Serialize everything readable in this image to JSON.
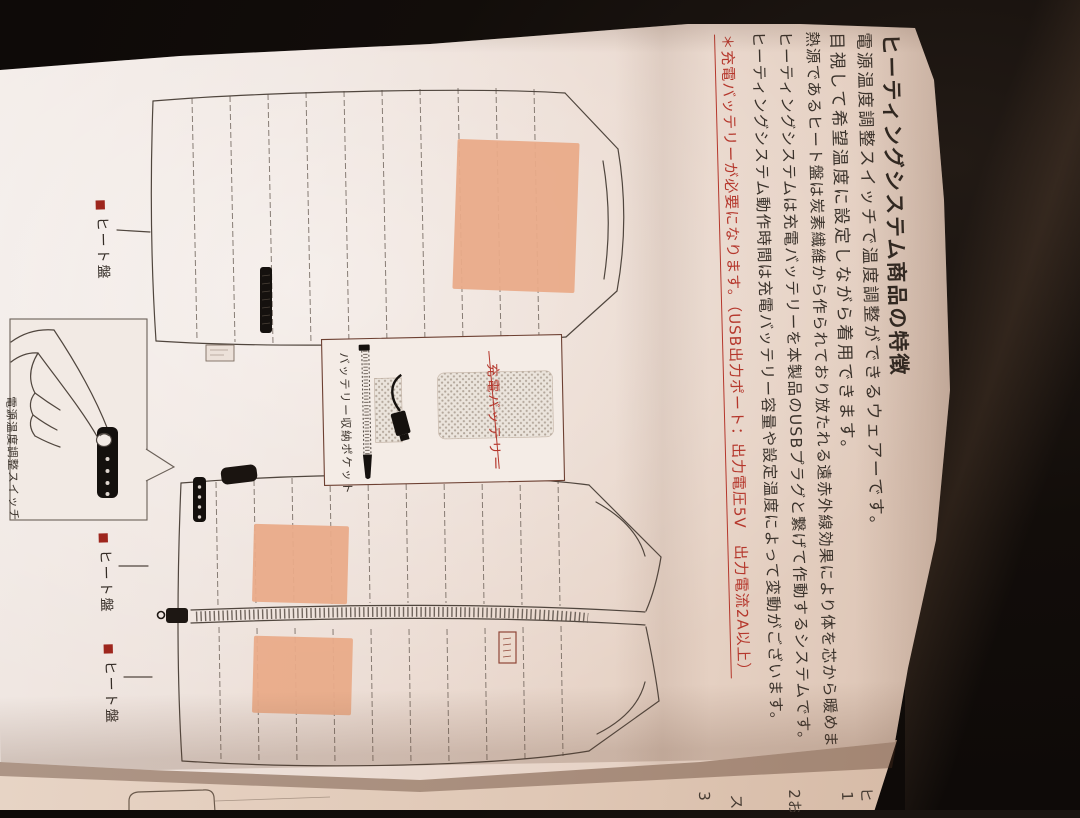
{
  "page": {
    "title": "ヒーティングシステム商品の特徴",
    "features": [
      "電源温度調整スイッチで温度調整ができるウェアーです。",
      "目視して希望温度に設定しながら着用できます。",
      "熱源であるヒート盤は炭素繊維から作られており放たれる遠赤外線効果により体を芯から暖めます。",
      "ヒーティングシステムは充電バッテリーを本製品のUSBプラグと繋げて作動するシステムです。",
      "ヒーティングシステム動作時間は充電バッテリー容量や設定温度によって変動がございます。"
    ],
    "note": {
      "text": "＊充電バッテリーが必要になります。（USB出力ポート：出力電圧5V　出力電流2A以上）",
      "color": "#b5372c"
    },
    "labels": {
      "heat_panel": "ヒート盤",
      "heat_panel_marker": "■",
      "power_switch": "電源温度調整スイッチ",
      "battery_pocket": "バッテリー収納ポケット",
      "charging_battery": "充電バッテリー"
    },
    "page2": {
      "fragments": [
        "ヒ",
        "1（",
        "2お",
        "ス",
        "3"
      ]
    },
    "colors": {
      "accent_red": "#b5372c",
      "label_square_red": "#9e261d",
      "heat_panel_fill": "#e9ab89",
      "paper": "#ece0d8",
      "background": "#0b0807"
    }
  }
}
